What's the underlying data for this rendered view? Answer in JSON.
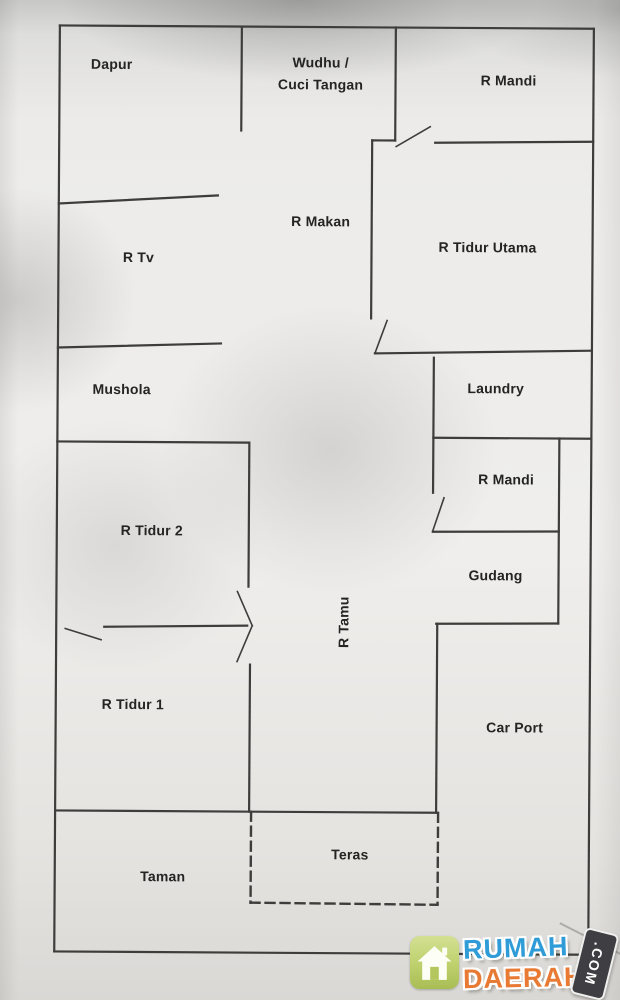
{
  "plan": {
    "rooms": [
      {
        "id": "dapur",
        "label": "Dapur",
        "x": 109,
        "y": 66
      },
      {
        "id": "wudhu-cuci-tangan",
        "label": "Wudhu /\nCuci Tangan",
        "x": 318,
        "y": 74
      },
      {
        "id": "r-mandi-atas",
        "label": "R Mandi",
        "x": 506,
        "y": 80
      },
      {
        "id": "r-makan",
        "label": "R Makan",
        "x": 319,
        "y": 222
      },
      {
        "id": "r-tidur-utama",
        "label": "R Tidur Utama",
        "x": 486,
        "y": 247
      },
      {
        "id": "r-tv",
        "label": "R Tv",
        "x": 137,
        "y": 259
      },
      {
        "id": "mushola",
        "label": "Mushola",
        "x": 121,
        "y": 391
      },
      {
        "id": "laundry",
        "label": "Laundry",
        "x": 495,
        "y": 388
      },
      {
        "id": "r-mandi-bawah",
        "label": "R Mandi",
        "x": 506,
        "y": 479
      },
      {
        "id": "r-tidur-2",
        "label": "R Tidur 2",
        "x": 152,
        "y": 532
      },
      {
        "id": "gudang",
        "label": "Gudang",
        "x": 496,
        "y": 575
      },
      {
        "id": "r-tamu",
        "label": "R Tamu",
        "x": 345,
        "y": 622,
        "rotate": -90
      },
      {
        "id": "r-tidur-1",
        "label": "R Tidur 1",
        "x": 134,
        "y": 706
      },
      {
        "id": "car-port",
        "label": "Car Port",
        "x": 516,
        "y": 727
      },
      {
        "id": "teras",
        "label": "Teras",
        "x": 352,
        "y": 855
      },
      {
        "id": "taman",
        "label": "Taman",
        "x": 165,
        "y": 878
      }
    ],
    "walls": [
      [
        57,
        27,
        591,
        27
      ],
      [
        57,
        27,
        57,
        953
      ],
      [
        591,
        27,
        591,
        953
      ],
      [
        57,
        953,
        591,
        953
      ],
      [
        239,
        27,
        239,
        131
      ],
      [
        393,
        27,
        393,
        140
      ],
      [
        370,
        140,
        393,
        140
      ],
      [
        370,
        140,
        370,
        318
      ],
      [
        433,
        142,
        591,
        140
      ],
      [
        57,
        205,
        216,
        196
      ],
      [
        57,
        349,
        220,
        344
      ],
      [
        374,
        353,
        591,
        349
      ],
      [
        57,
        443,
        248,
        443
      ],
      [
        249,
        443,
        249,
        587
      ],
      [
        105,
        628,
        248,
        626
      ],
      [
        251,
        665,
        251,
        812
      ],
      [
        433,
        357,
        433,
        492
      ],
      [
        433,
        437,
        591,
        437
      ],
      [
        559,
        437,
        559,
        622
      ],
      [
        433,
        531,
        559,
        530
      ],
      [
        437,
        623,
        559,
        622
      ],
      [
        438,
        623,
        438,
        812
      ],
      [
        57,
        812,
        438,
        812
      ]
    ],
    "door_leaves": [
      [
        394,
        146,
        428,
        126
      ],
      [
        374,
        353,
        386,
        320
      ],
      [
        433,
        530,
        444,
        497
      ],
      [
        66,
        630,
        102,
        641
      ],
      [
        238,
        592,
        253,
        626
      ],
      [
        253,
        626,
        238,
        662
      ]
    ],
    "dashed_walls": [
      [
        253,
        812,
        253,
        903
      ],
      [
        253,
        903,
        440,
        904
      ],
      [
        440,
        812,
        440,
        903
      ]
    ],
    "wall_color": "#3d3d3c"
  },
  "watermark": {
    "word1": "RUMAH",
    "word2": "DAERAH",
    "tld": ".COM",
    "icon": "house-icon",
    "colors": {
      "word1": "#2f9cd8",
      "word2": "#e87a33",
      "badge": "#bdd06c",
      "tag": "#3f3e43"
    }
  }
}
